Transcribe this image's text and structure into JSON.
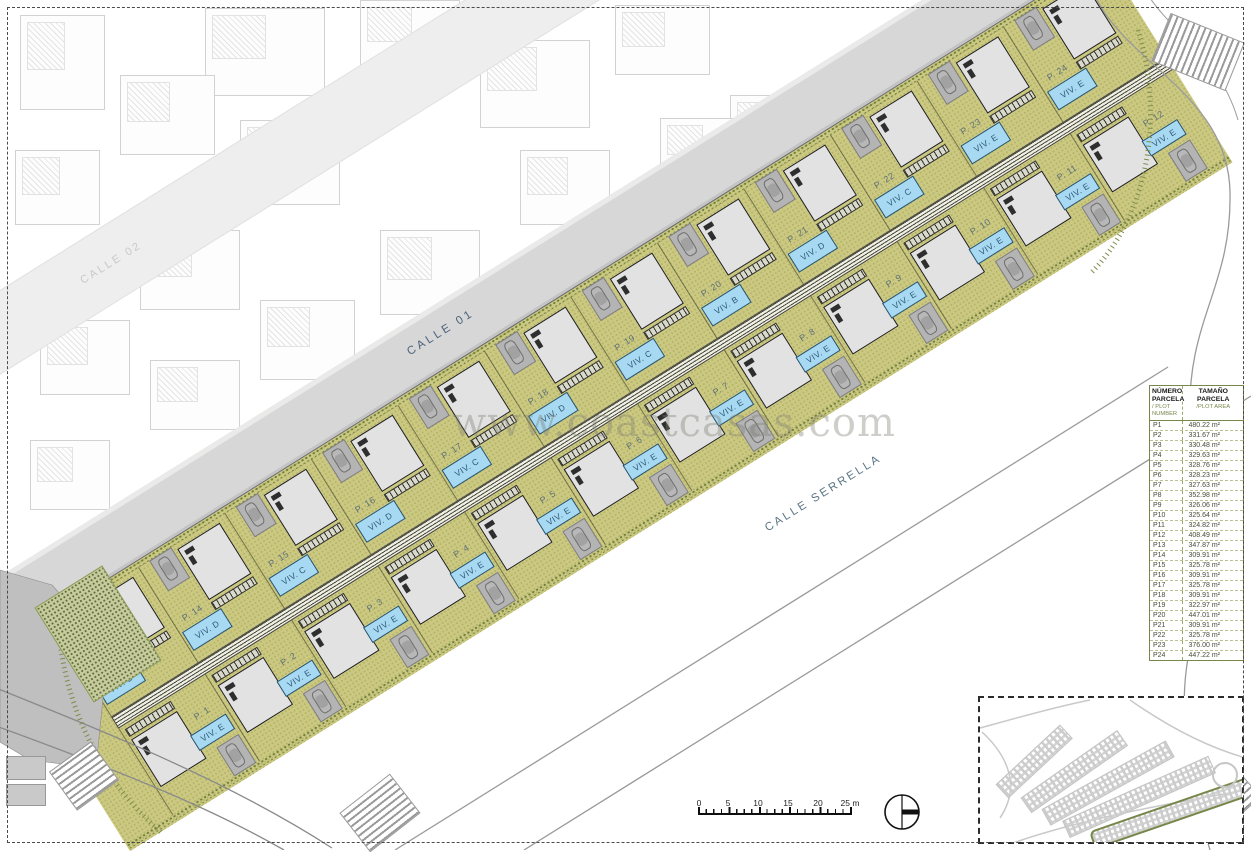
{
  "streets": {
    "calle_01": "CALLE 01",
    "calle_02": "CALLE 02",
    "calle_serrella": "CALLE SERRELLA"
  },
  "watermark": "www.coastcasas.com",
  "plots": {
    "upper_row": [
      {
        "number": "P. 13",
        "viv": "VIV. B"
      },
      {
        "number": "P. 14",
        "viv": "VIV. D"
      },
      {
        "number": "P. 15",
        "viv": "VIV. C"
      },
      {
        "number": "P. 16",
        "viv": "VIV. D"
      },
      {
        "number": "P. 17",
        "viv": "VIV. C"
      },
      {
        "number": "P. 18",
        "viv": "VIV. D"
      },
      {
        "number": "P. 19",
        "viv": "VIV. C"
      },
      {
        "number": "P. 20",
        "viv": "VIV. B"
      },
      {
        "number": "P. 21",
        "viv": "VIV. D"
      },
      {
        "number": "P. 22",
        "viv": "VIV. C"
      },
      {
        "number": "P. 23",
        "viv": "VIV. E"
      },
      {
        "number": "P. 24",
        "viv": "VIV. E"
      }
    ],
    "lower_row": [
      {
        "number": "P. 1",
        "viv": "VIV. E"
      },
      {
        "number": "P. 2",
        "viv": "VIV. E"
      },
      {
        "number": "P. 3",
        "viv": "VIV. E"
      },
      {
        "number": "P. 4",
        "viv": "VIV. E"
      },
      {
        "number": "P. 5",
        "viv": "VIV. E"
      },
      {
        "number": "P. 6",
        "viv": "VIV. E"
      },
      {
        "number": "P. 7",
        "viv": "VIV. E"
      },
      {
        "number": "P. 8",
        "viv": "VIV. E"
      },
      {
        "number": "P. 9",
        "viv": "VIV. E"
      },
      {
        "number": "P. 10",
        "viv": "VIV. E"
      },
      {
        "number": "P. 11",
        "viv": "VIV. E"
      },
      {
        "number": "P. 12",
        "viv": "VIV. E"
      }
    ]
  },
  "table": {
    "header": {
      "col1_main": "NÚMERO PARCELA",
      "col1_sub": "/ PLOT NUMBER",
      "col2_main": "TAMAÑO PARCELA",
      "col2_sub": "/PLOT AREA"
    },
    "rows": [
      {
        "plot": "P1",
        "area": "480.22 m²"
      },
      {
        "plot": "P2",
        "area": "331.67 m²"
      },
      {
        "plot": "P3",
        "area": "330.48 m²"
      },
      {
        "plot": "P4",
        "area": "329.63 m²"
      },
      {
        "plot": "P5",
        "area": "328.76 m²"
      },
      {
        "plot": "P6",
        "area": "328.23 m²"
      },
      {
        "plot": "P7",
        "area": "327.63 m²"
      },
      {
        "plot": "P8",
        "area": "352.98 m²"
      },
      {
        "plot": "P9",
        "area": "326.06 m²"
      },
      {
        "plot": "P10",
        "area": "325.64 m²"
      },
      {
        "plot": "P11",
        "area": "324.82 m²"
      },
      {
        "plot": "P12",
        "area": "408.49 m²"
      },
      {
        "plot": "P13",
        "area": "347.87 m²"
      },
      {
        "plot": "P14",
        "area": "309.91 m²"
      },
      {
        "plot": "P15",
        "area": "325.78 m²"
      },
      {
        "plot": "P16",
        "area": "309.91 m²"
      },
      {
        "plot": "P17",
        "area": "325.78 m²"
      },
      {
        "plot": "P18",
        "area": "309.91 m²"
      },
      {
        "plot": "P19",
        "area": "322.97 m²"
      },
      {
        "plot": "P20",
        "area": "447.01 m²"
      },
      {
        "plot": "P21",
        "area": "309.91 m²"
      },
      {
        "plot": "P22",
        "area": "325.78 m²"
      },
      {
        "plot": "P23",
        "area": "376.00 m²"
      },
      {
        "plot": "P24",
        "area": "447.22 m²"
      }
    ]
  },
  "scale_bar": {
    "labels": [
      "0",
      "5",
      "10",
      "15",
      "20",
      "25 m"
    ]
  },
  "icons": {
    "north_arrow": "north-arrow"
  },
  "colors": {
    "plot_green": "#cbc981",
    "pool_blue": "#a8d9f2",
    "hedge_green": "#77874a",
    "road_gray": "#d7d7d7",
    "table_accent": "#77874a",
    "label_blue": "#2f5a74",
    "site_outline_green": "#77874a"
  }
}
